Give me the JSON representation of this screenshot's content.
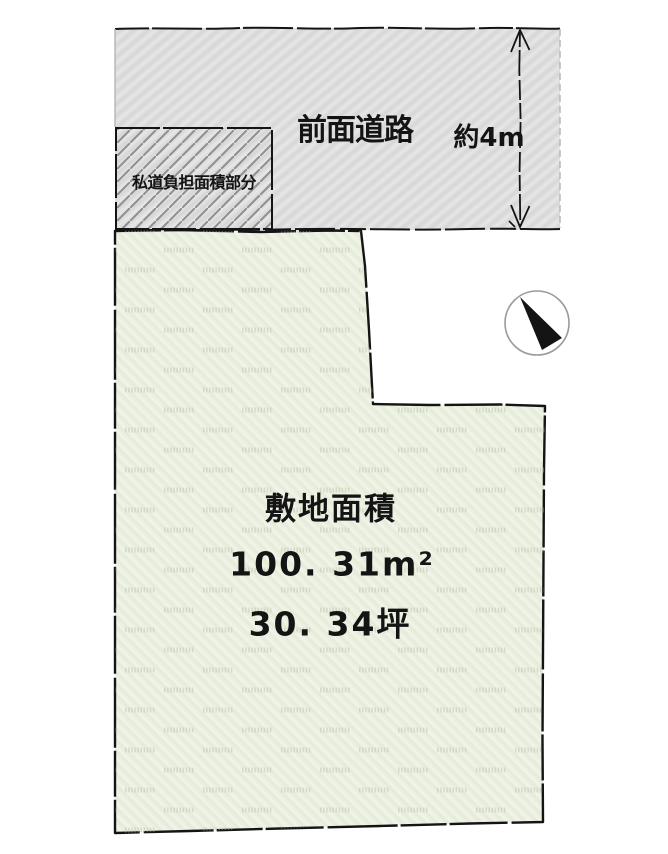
{
  "road": {
    "label": "前面道路",
    "width_label": "約4m"
  },
  "private_road": {
    "label": "私道負担面積部分"
  },
  "site": {
    "title": "敷地面積",
    "area_sqm_text": "100. 31m²",
    "area_tsubo_text": "30. 34坪",
    "area_sqm_value": 100.31,
    "area_tsubo_value": 30.34
  },
  "compass": {
    "icon": "north-arrow"
  },
  "colors": {
    "outline": "#141414",
    "road_fill": "#dedede",
    "road_fill_alt": "#d7d7d7",
    "hatch_line": "#8f8f8f",
    "site_fill": "#ebf0e2",
    "site_fill_alt": "#e4ebd7",
    "watermark": "#b4bfa3",
    "compass_ring": "#9a9a9a",
    "background": "#ffffff"
  }
}
